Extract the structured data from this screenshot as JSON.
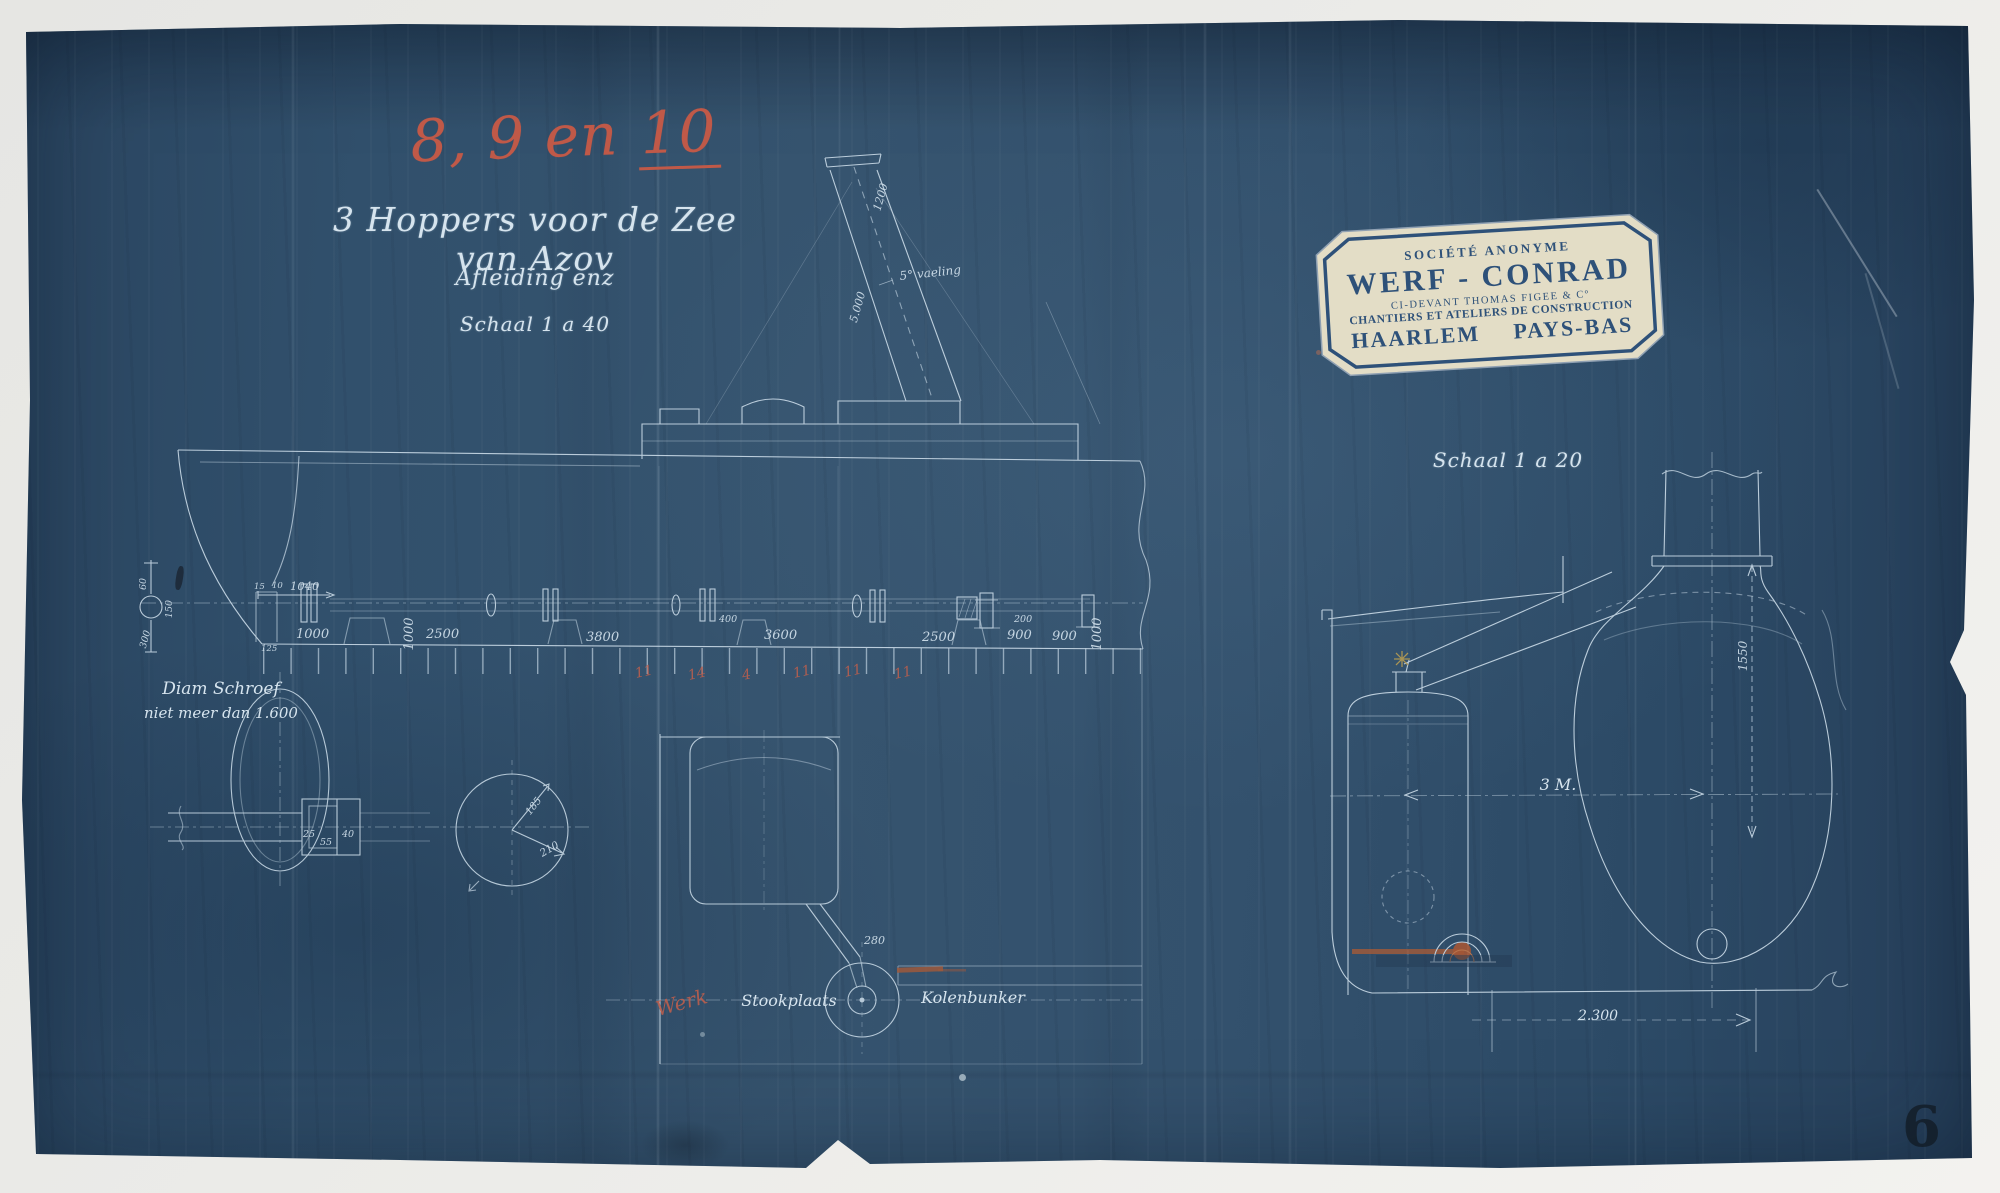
{
  "annotations": {
    "red_number_part1": "8, 9 en",
    "red_number_part2": "10",
    "title": "3 Hoppers voor de Zee van Azov",
    "subtitle": "Afleiding enz",
    "scale_left": "Schaal 1 a 40",
    "scale_right": "Schaal 1 a 20",
    "red_note": "Werk",
    "page_number": "6"
  },
  "stamp": {
    "line1": "SOCIÉTÉ ANONYME",
    "line2": "WERF - CONRAD",
    "line3": "CI-DEVANT THOMAS FIGEE & Cº",
    "line4": "CHANTIERS ET ATELIERS DE CONSTRUCTION",
    "line5_a": "HAARLEM",
    "line5_b": "PAYS-BAS"
  },
  "side_view": {
    "note_line1": "Diam Schroef",
    "note_line2": "niet meer dan 1.600",
    "dims": {
      "rudder_top": "60",
      "rudder_mid": "150",
      "rudder_bottom": "300",
      "stern_a": "15",
      "stern_b": "10",
      "stern_c": "125",
      "stern_width": "1040",
      "bay_1": "1000",
      "bay_2": "2500",
      "bay_3": "3800",
      "bay_4": "3600",
      "bay_5": "2500",
      "bay_6": "900",
      "bay_7": "900",
      "vert_a": "1000",
      "vert_b": "1000",
      "small_a": "400",
      "small_b": "200",
      "funnel_top": "1200",
      "funnel_length": "5.000",
      "funnel_rake": "5° vaeling",
      "hub_a": "25",
      "hub_b": "55",
      "hub_c": "40",
      "shaft_r1": "185",
      "shaft_r2": "210",
      "rod": "280"
    },
    "red_frames": [
      "11",
      "14",
      "4",
      "11",
      "11",
      "11"
    ],
    "labels": {
      "stookplaats": "Stookplaats",
      "kolenbunker": "Kolenbunker"
    }
  },
  "cross_section": {
    "height": "1550",
    "beam": "3 M.",
    "bottom_width": "2.300"
  },
  "colors": {
    "blueprint": "#31506c",
    "linework": "#cfdfeb",
    "red_ink": "#c05948",
    "stamp_paper": "#e3ddc6",
    "stamp_ink": "#2e5179",
    "orange_mark": "#b45c32"
  }
}
